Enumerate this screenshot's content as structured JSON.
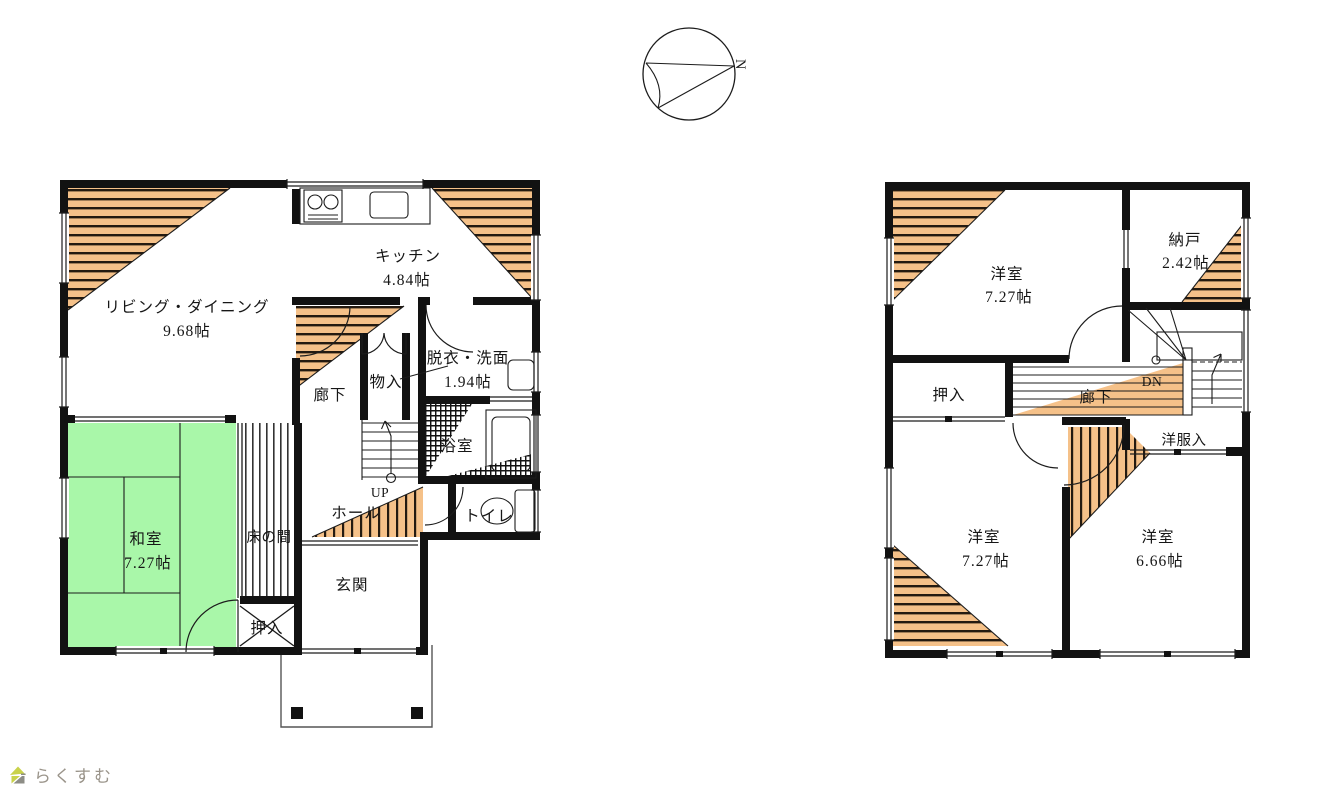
{
  "page": {
    "logo": "らくすむ",
    "background": "#ffffff"
  },
  "compass": {
    "north": "N"
  },
  "colors": {
    "wall": "#121212",
    "hatch_orange": "#f5c189",
    "hatch_stripe": "#241a10",
    "tatami_green": "#a9f7a9",
    "fixture_cyan": "#6fe6ee",
    "logo_green": "#c9d24b",
    "logo_gray": "#8d8d86",
    "text": "#161616"
  },
  "floor1": {
    "living": {
      "name": "リビング・ダイニング",
      "area": "9.68帖"
    },
    "kitchen": {
      "name": "キッチン",
      "area": "4.84帖"
    },
    "corridor": {
      "name": "廊下"
    },
    "storage": {
      "name": "物入"
    },
    "washroom": {
      "name": "脱衣・洗面",
      "area": "1.94帖"
    },
    "bathroom": {
      "name": "浴室"
    },
    "toilet": {
      "name": "トイレ"
    },
    "hall": {
      "name": "ホール"
    },
    "stairs": {
      "name": "UP"
    },
    "entrance": {
      "name": "玄関"
    },
    "tatami": {
      "name": "和室",
      "area": "7.27帖"
    },
    "tokonoma": {
      "name": "床の間"
    },
    "closet": {
      "name": "押入"
    }
  },
  "floor2": {
    "bedroom_nw": {
      "name": "洋室",
      "area": "7.27帖"
    },
    "storeroom": {
      "name": "納戸",
      "area": "2.42帖"
    },
    "closet": {
      "name": "押入"
    },
    "corridor": {
      "name": "廊下"
    },
    "stairs": {
      "name": "DN"
    },
    "wardrobe": {
      "name": "洋服入"
    },
    "bedroom_sw": {
      "name": "洋室",
      "area": "7.27帖"
    },
    "bedroom_se": {
      "name": "洋室",
      "area": "6.66帖"
    }
  }
}
